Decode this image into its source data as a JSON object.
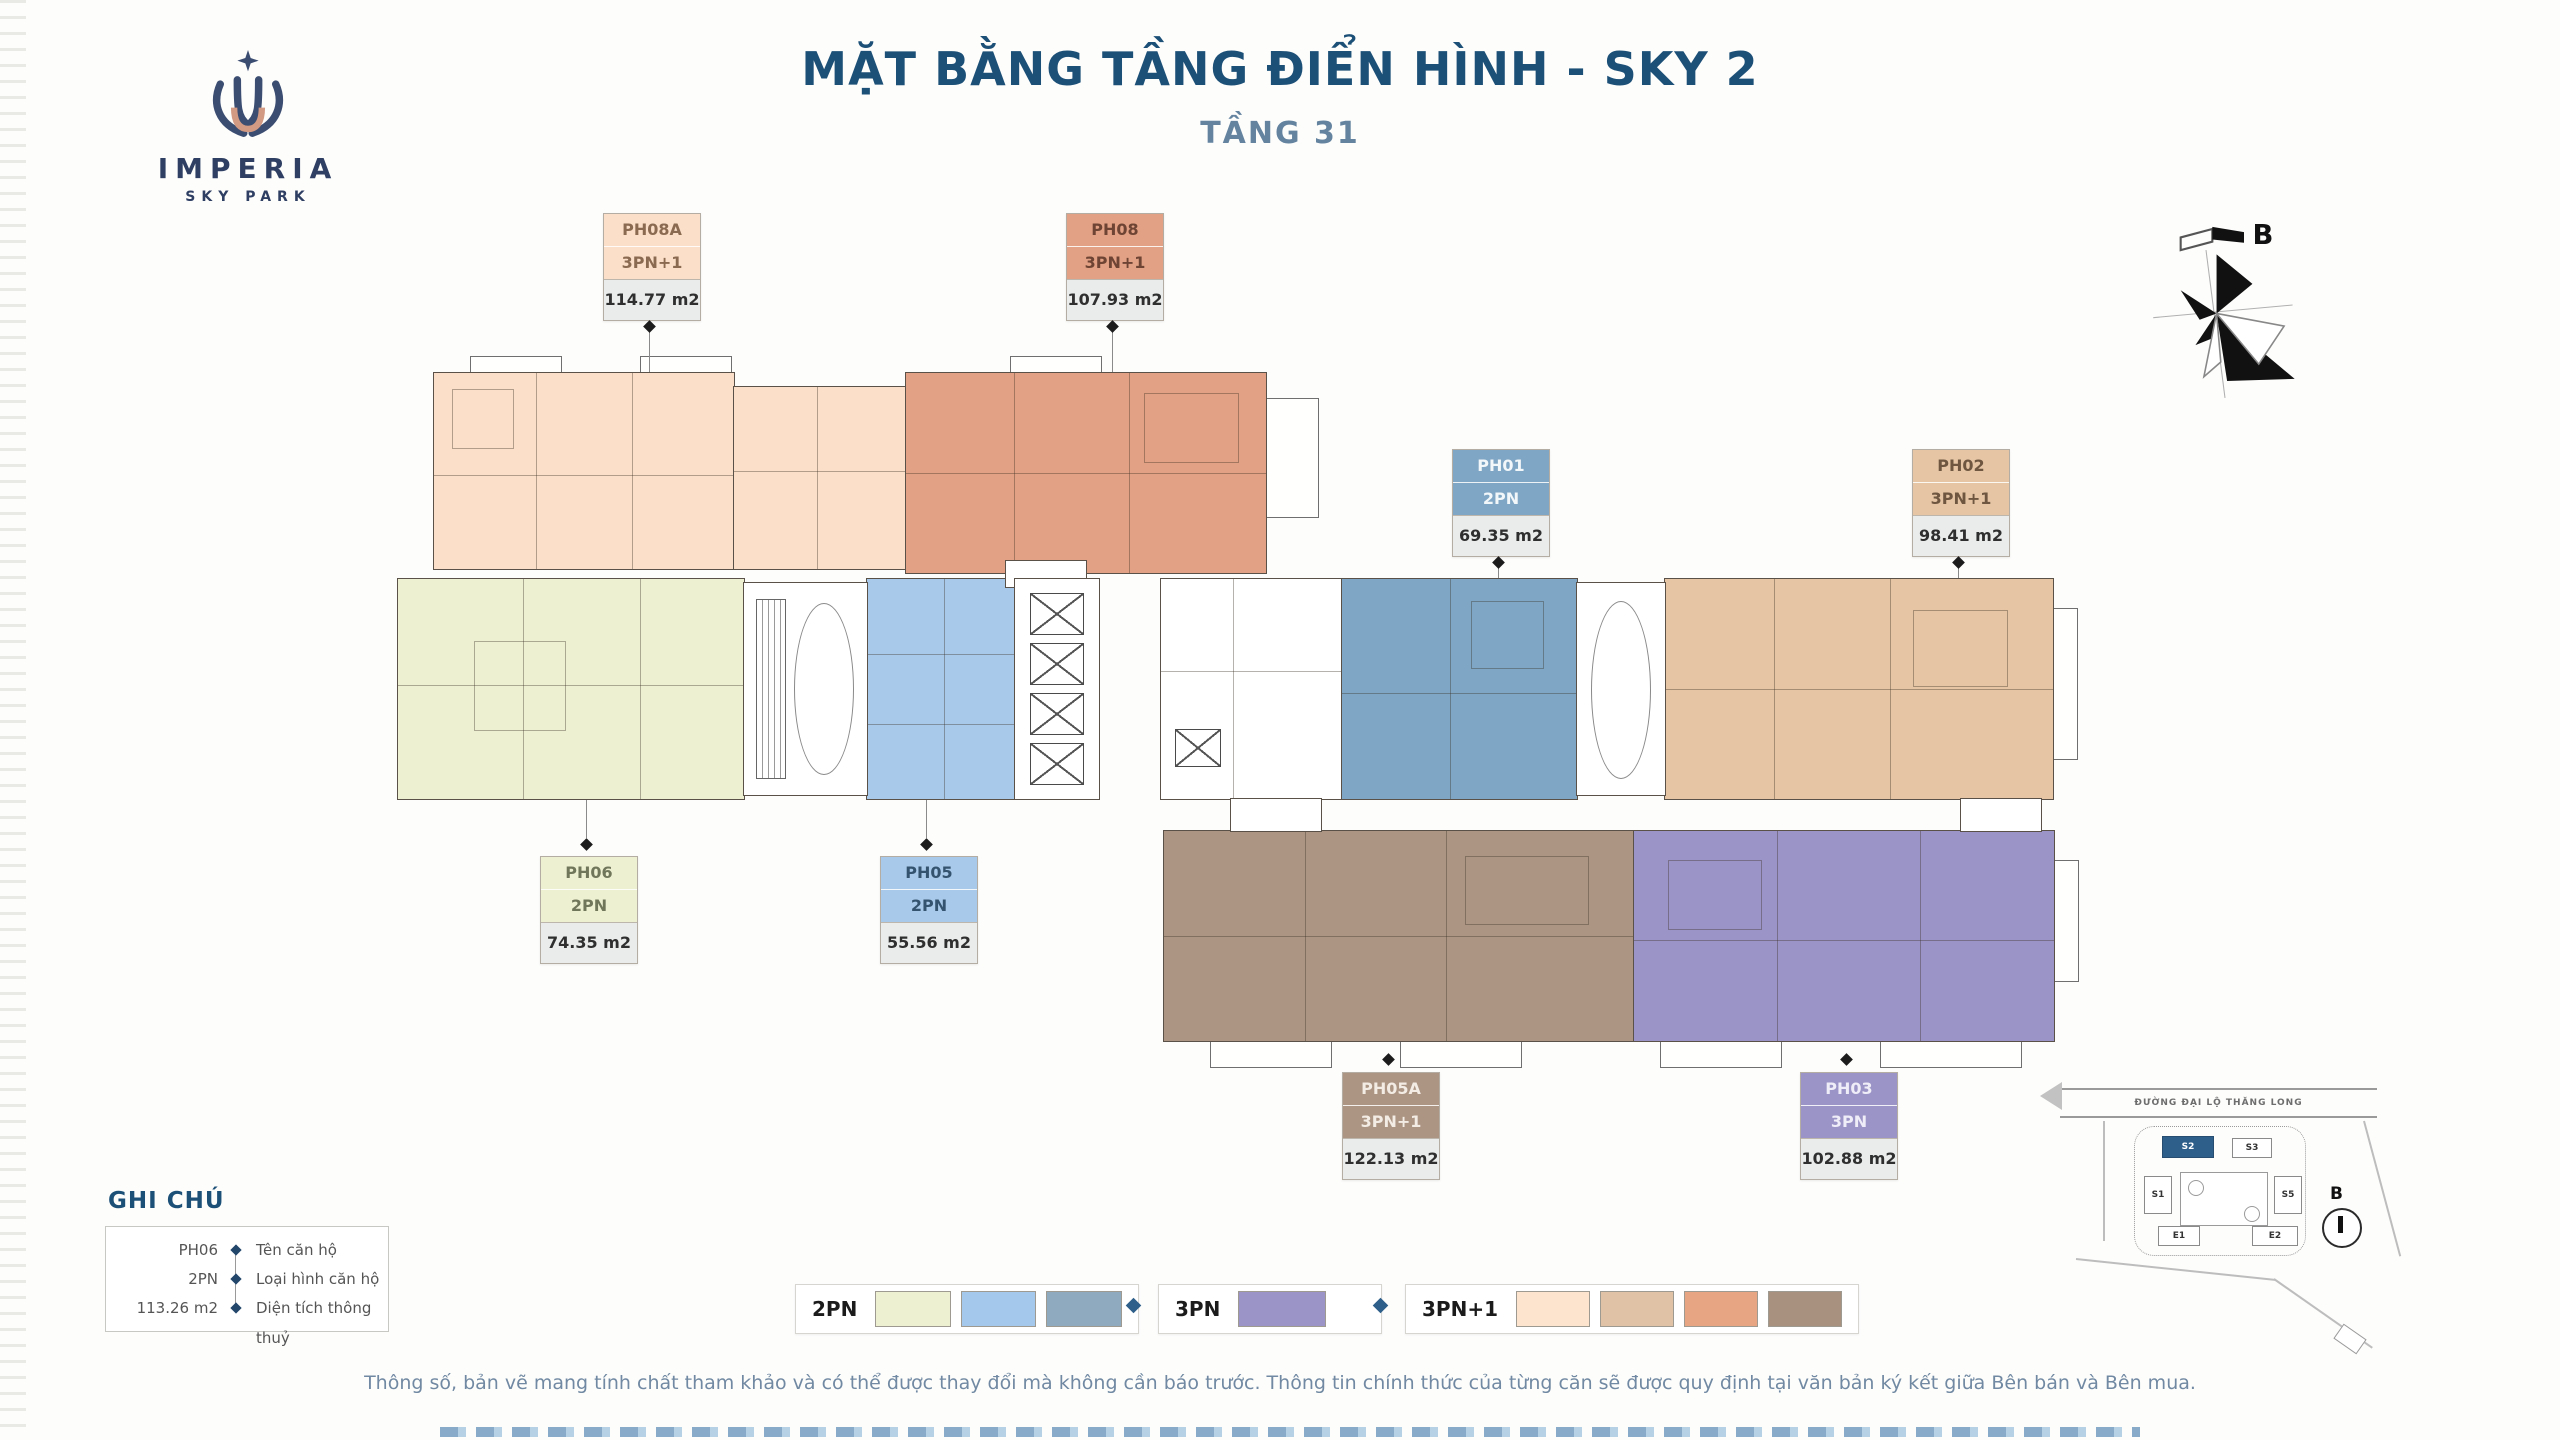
{
  "header": {
    "title": "MẶT BẰNG TẦNG ĐIỂN HÌNH - SKY 2",
    "subtitle": "TẦNG 31",
    "brand": {
      "name": "IMPERIA",
      "sub": "SKY PARK"
    },
    "compass_label": "B"
  },
  "colors": {
    "title": "#1d5077",
    "subtitle": "#64839f",
    "accent_diamond": "#2e5f8a",
    "area_row_bg": "#e9eceb"
  },
  "units": {
    "ph08a": {
      "name": "PH08A",
      "type": "3PN+1",
      "area": "114.77 m2",
      "color": "#fbdfc8",
      "text": "#8a6a50"
    },
    "ph08": {
      "name": "PH08",
      "type": "3PN+1",
      "area": "107.93 m2",
      "color": "#e2a184",
      "text": "#6e4434"
    },
    "ph01": {
      "name": "PH01",
      "type": "2PN",
      "area": "69.35 m2",
      "color": "#7fa6c4",
      "text": "#f2f7fa"
    },
    "ph02": {
      "name": "PH02",
      "type": "3PN+1",
      "area": "98.41 m2",
      "color": "#e5c5a4",
      "text": "#6e5640"
    },
    "ph06": {
      "name": "PH06",
      "type": "2PN",
      "area": "74.35 m2",
      "color": "#eef0d2",
      "text": "#70765a"
    },
    "ph05": {
      "name": "PH05",
      "type": "2PN",
      "area": "55.56 m2",
      "color": "#a9c9ea",
      "text": "#33536e"
    },
    "ph05a": {
      "name": "PH05A",
      "type": "3PN+1",
      "area": "122.13 m2",
      "color": "#ac9583",
      "text": "#f3ece5"
    },
    "ph03": {
      "name": "PH03",
      "type": "3PN",
      "area": "102.88 m2",
      "color": "#9b94c6",
      "text": "#efedf8"
    }
  },
  "notes_legend": {
    "title": "GHI CHÚ",
    "rows": [
      {
        "value": "PH06",
        "label": "Tên căn hộ"
      },
      {
        "value": "2PN",
        "label": "Loại hình căn hộ"
      },
      {
        "value": "113.26 m2",
        "label": "Diện tích thông thuỷ"
      }
    ]
  },
  "type_legend": {
    "groups": [
      {
        "label": "2PN",
        "colors": [
          "#eef0d2",
          "#a3c8ec",
          "#8fa9bf"
        ]
      },
      {
        "label": "3PN",
        "colors": [
          "#9b94c6"
        ]
      },
      {
        "label": "3PN+1",
        "colors": [
          "#fce4cf",
          "#e0c2a6",
          "#e8a583",
          "#a8927f"
        ]
      }
    ]
  },
  "sitemap": {
    "road_label": "ĐƯỜNG ĐẠI LỘ THĂNG LONG",
    "north_label": "B",
    "buildings": [
      {
        "id": "S2",
        "highlighted": true
      },
      {
        "id": "S3",
        "highlighted": false
      },
      {
        "id": "S1",
        "highlighted": false
      },
      {
        "id": "S5",
        "highlighted": false
      },
      {
        "id": "E1",
        "highlighted": false
      },
      {
        "id": "E2",
        "highlighted": false
      }
    ]
  },
  "disclaimer": "Thông số, bản vẽ mang tính chất tham khảo và có thể được thay đổi mà không cần báo trước. Thông tin chính thức của từng căn sẽ được quy định tại văn bản ký kết giữa Bên bán và Bên mua."
}
